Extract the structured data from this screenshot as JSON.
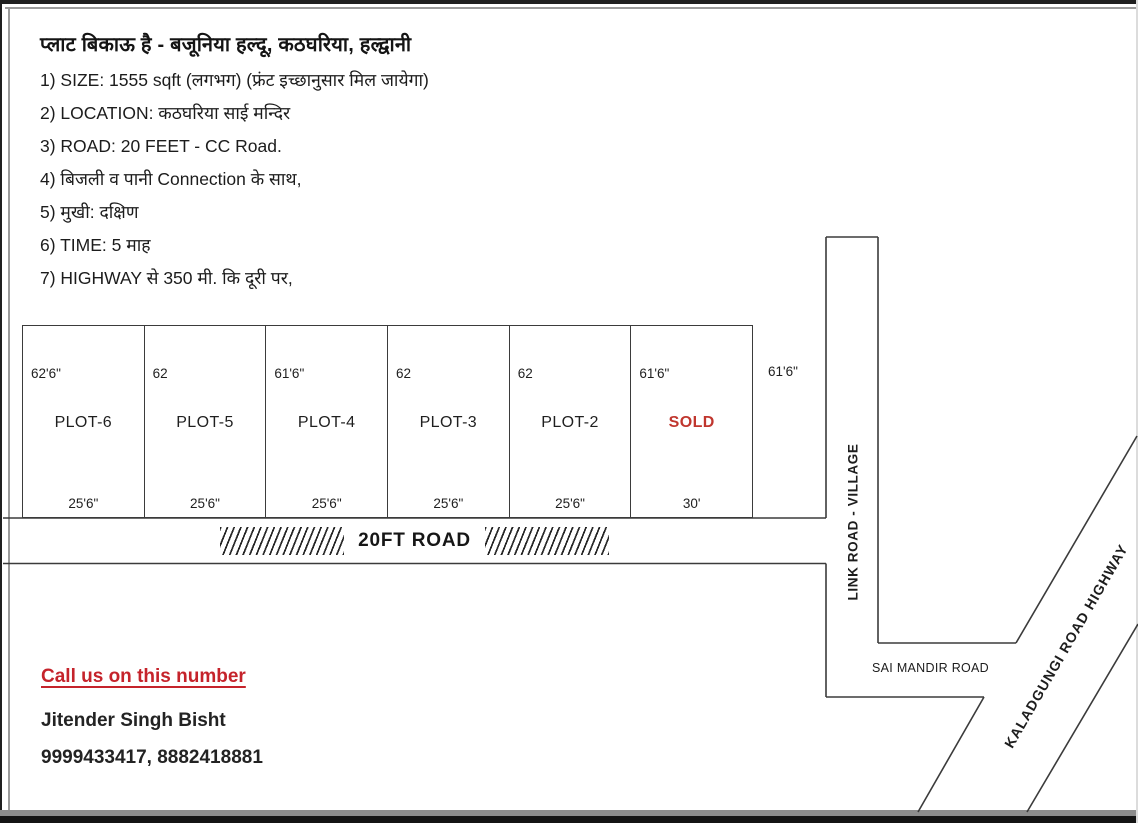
{
  "page": {
    "title": "प्लाट बिकाऊ है - बजूनिया हल्दू, कठघरिया, हल्द्वानी",
    "details": [
      "1) SIZE: 1555 sqft (लगभग) (फ्रंट इच्छानुसार मिल जायेगा)",
      "2) LOCATION: कठघरिया साई मन्दिर",
      "3) ROAD: 20 FEET - CC Road.",
      "4) बिजली व पानी Connection के साथ,",
      "5) मुखी: दक्षिण",
      "6) TIME: 5 माह",
      "7) HIGHWAY से 350 मी. कि दूरी पर,"
    ]
  },
  "plots": [
    {
      "name": "PLOT-6",
      "height": "62'6\"",
      "width": "25'6\""
    },
    {
      "name": "PLOT-5",
      "height": "62",
      "width": "25'6\""
    },
    {
      "name": "PLOT-4",
      "height": "61'6\"",
      "width": "25'6\""
    },
    {
      "name": "PLOT-3",
      "height": "62",
      "width": "25'6\""
    },
    {
      "name": "PLOT-2",
      "height": "62",
      "width": "25'6\""
    },
    {
      "name": "SOLD",
      "height": "61'6\"",
      "width": "30'"
    }
  ],
  "outside_dim": "61'6\"",
  "roads": {
    "front_road": "20FT ROAD",
    "link_road": "LINK ROAD - VILLAGE",
    "sai_mandir_road": "SAI MANDIR ROAD",
    "highway": "KALADGUNGI ROAD HIGHWAY"
  },
  "contact": {
    "heading": "Call us on this number",
    "name": "Jitender Singh Bisht",
    "phones": "9999433417, 8882418881"
  },
  "colors": {
    "accent_red": "#c5232b",
    "sold_red": "#c0362e",
    "line": "#3b3b3b"
  }
}
